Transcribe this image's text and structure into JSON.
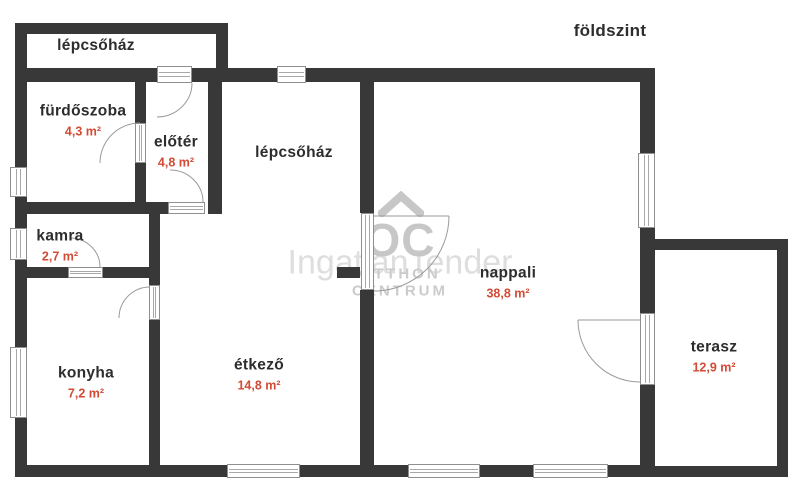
{
  "header": {
    "floor_label": "földszint"
  },
  "watermark": {
    "text": "IngatlanTender",
    "logo_monogram": "OC",
    "logo_line1": "OTTHON",
    "logo_line2": "CENTRUM"
  },
  "colors": {
    "wall": "#383838",
    "room_label": "#2d2d2d",
    "area_label": "#d24b35",
    "watermark": "#dedede",
    "frame_line": "#a8a8a8"
  },
  "rooms": [
    {
      "id": "lepcsohaz-annex",
      "label": "lépcsőház",
      "area": ""
    },
    {
      "id": "furdoszoba",
      "label": "fürdőszoba",
      "area": "4,3 m²"
    },
    {
      "id": "eloter",
      "label": "előtér",
      "area": "4,8 m²"
    },
    {
      "id": "lepcsohaz",
      "label": "lépcsőház",
      "area": ""
    },
    {
      "id": "kamra",
      "label": "kamra",
      "area": "2,7 m²"
    },
    {
      "id": "konyha",
      "label": "konyha",
      "area": "7,2 m²"
    },
    {
      "id": "etkezo",
      "label": "étkező",
      "area": "14,8 m²"
    },
    {
      "id": "nappali",
      "label": "nappali",
      "area": "38,8 m²"
    },
    {
      "id": "terasz",
      "label": "terasz",
      "area": "12,9 m²"
    }
  ]
}
